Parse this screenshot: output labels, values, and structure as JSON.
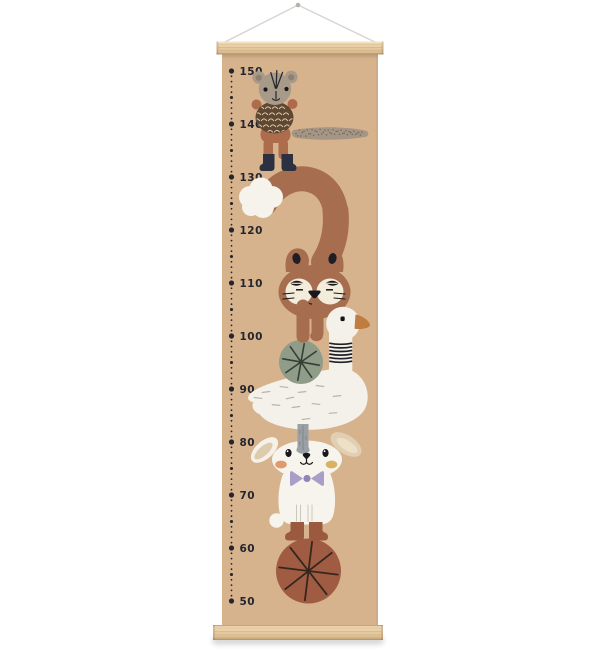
{
  "image": {
    "width": 600,
    "height": 649,
    "background": "#ffffff"
  },
  "ruler": {
    "labels": [
      "150",
      "140",
      "130",
      "120",
      "110",
      "100",
      "90",
      "80",
      "70",
      "60",
      "50"
    ],
    "max": 150,
    "min": 50,
    "major_step": 10,
    "minor_step": 1
  },
  "palette": {
    "background": "#ffffff",
    "poster": "#d7b38d",
    "ink": "#24252d",
    "string": "#d8d5d0",
    "wood_light": "#f2dcb8",
    "wood_dark": "#d3b184",
    "squirrel_fur": "#a89a88",
    "squirrel_body": "#ad6c4c",
    "acorn_brown": "#5e4733",
    "boots_navy": "#2b3140",
    "fox_brown": "#a76d4f",
    "fox_muzzle_cream": "#f3ecda",
    "fox_tail_tip_white": "#f6f3ec",
    "goose_white": "#f4f1ea",
    "beak_orange": "#c07c41",
    "goose_leg_gray": "#9aa0a3",
    "green_ball": "#8e9c88",
    "rabbit_white": "#f7f4ee",
    "ear_beige": "#e0cfb2",
    "cheek_coral": "#df9a6d",
    "cheek_mustard": "#d9b25f",
    "bow_lavender": "#a89fc8",
    "boots_rust": "#9b5a40",
    "rust_ball": "#a05c42"
  },
  "illustration": {
    "characters": [
      {
        "name": "squirrel-with-acorn"
      },
      {
        "name": "fox-curled"
      },
      {
        "name": "goose"
      },
      {
        "name": "rabbit-with-bow-tie"
      }
    ],
    "props": [
      {
        "name": "green-segmented-ball"
      },
      {
        "name": "rust-segmented-ball"
      },
      {
        "name": "wooden-hanger-bars"
      },
      {
        "name": "hanging-string"
      }
    ]
  }
}
